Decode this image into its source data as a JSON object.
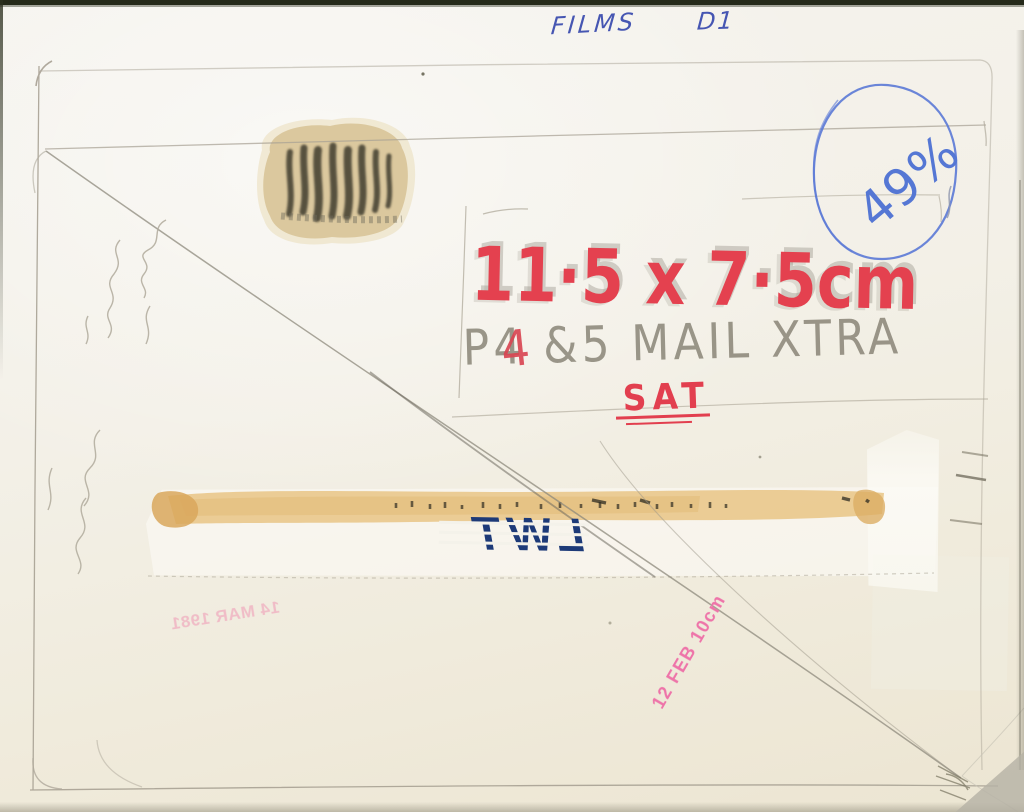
{
  "ink_notes": {
    "films_label": "FILMS",
    "page_code": "D1",
    "scale_percent": "49%"
  },
  "marker_notes": {
    "size": "11·5 x 7·5cm",
    "overstrike": "4",
    "day": "SAT"
  },
  "pencil_notes": {
    "layout": "P4 &5 MAIL XTRA"
  },
  "stamps": {
    "broadcaster_logo": "LWT",
    "logo_mirrored": true,
    "date_stamp_mirrored": "14 MAR 1981",
    "date_stamp_vertical": "12 FEB 10cm"
  },
  "colors": {
    "ink_blue": "#4656b2",
    "ballpoint_blue": "#5577d4",
    "marker_red": "#e4414f",
    "pencil_gray": "#9d978a",
    "logo_navy": "#1d3a78",
    "stamp_pink": "#ee74a9",
    "stamp_pink_faint": "#f0a8be",
    "glue_tan": "#e7c27e",
    "paper": "#f3f0e7"
  }
}
